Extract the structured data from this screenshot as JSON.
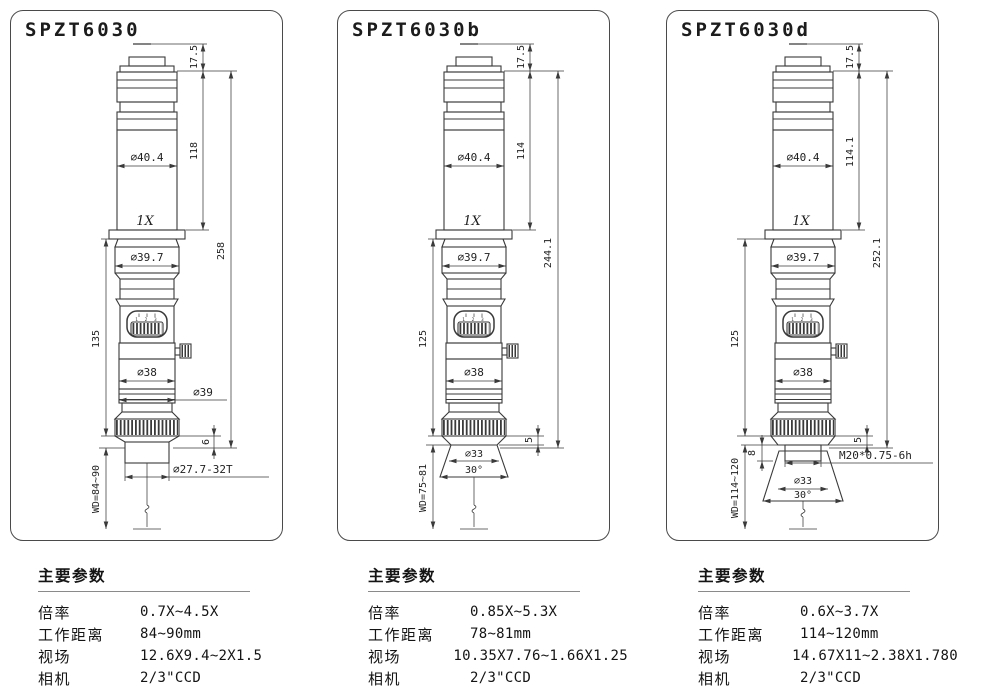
{
  "colors": {
    "line": "#3a3a3a",
    "text": "#1f1f1f",
    "rule": "#8a8a8a",
    "background": "#ffffff"
  },
  "panels": [
    {
      "title": "SPZT6030",
      "zoom_marks": "1 2 3",
      "dims": {
        "flange_height": "17.5",
        "body_length": "118",
        "total_length": "258",
        "body_dia": "∅40.4",
        "mag": "1X",
        "neck_dia": "∅39.7",
        "lower_length": "135",
        "mid_dia": "∅38",
        "knurl_dia": "∅39",
        "step": "6",
        "tip": "∅27.7-32T",
        "wd": "WD=84~90"
      },
      "specs": {
        "header": "主要参数",
        "rows": [
          {
            "label": "倍率",
            "value": "0.7X~4.5X"
          },
          {
            "label": "工作距离",
            "value": "84~90mm"
          },
          {
            "label": "视场",
            "value": "12.6X9.4~2X1.5"
          },
          {
            "label": "相机",
            "value": "2/3\"CCD"
          }
        ]
      }
    },
    {
      "title": "SPZT6030b",
      "zoom_marks": "1 2 3",
      "dims": {
        "flange_height": "17.5",
        "body_length": "114",
        "total_length": "244.1",
        "body_dia": "∅40.4",
        "mag": "1X",
        "neck_dia": "∅39.7",
        "lower_length": "125",
        "mid_dia": "∅38",
        "step": "5",
        "cone_dia": "∅33",
        "cone_angle": "30°",
        "wd": "WD=75~81"
      },
      "specs": {
        "header": "主要参数",
        "rows": [
          {
            "label": "倍率",
            "value": "0.85X~5.3X"
          },
          {
            "label": "工作距离",
            "value": "78~81mm"
          },
          {
            "label": "视场",
            "value": "10.35X7.76~1.66X1.25"
          },
          {
            "label": "相机",
            "value": "2/3\"CCD"
          }
        ]
      }
    },
    {
      "title": "SPZT6030d",
      "zoom_marks": "1 2 3",
      "dims": {
        "flange_height": "17.5",
        "body_length": "114.1",
        "total_length": "252.1",
        "body_dia": "∅40.4",
        "mag": "1X",
        "neck_dia": "∅39.7",
        "lower_length": "125",
        "mid_dia": "∅38",
        "step": "5",
        "mount_step": "8",
        "thread": "M20*0.75-6h",
        "cone_dia": "∅33",
        "cone_angle": "30°",
        "wd": "WD=114~120"
      },
      "specs": {
        "header": "主要参数",
        "rows": [
          {
            "label": "倍率",
            "value": "0.6X~3.7X"
          },
          {
            "label": "工作距离",
            "value": "114~120mm"
          },
          {
            "label": "视场",
            "value": "14.67X11~2.38X1.780"
          },
          {
            "label": "相机",
            "value": "2/3\"CCD"
          }
        ]
      }
    }
  ]
}
